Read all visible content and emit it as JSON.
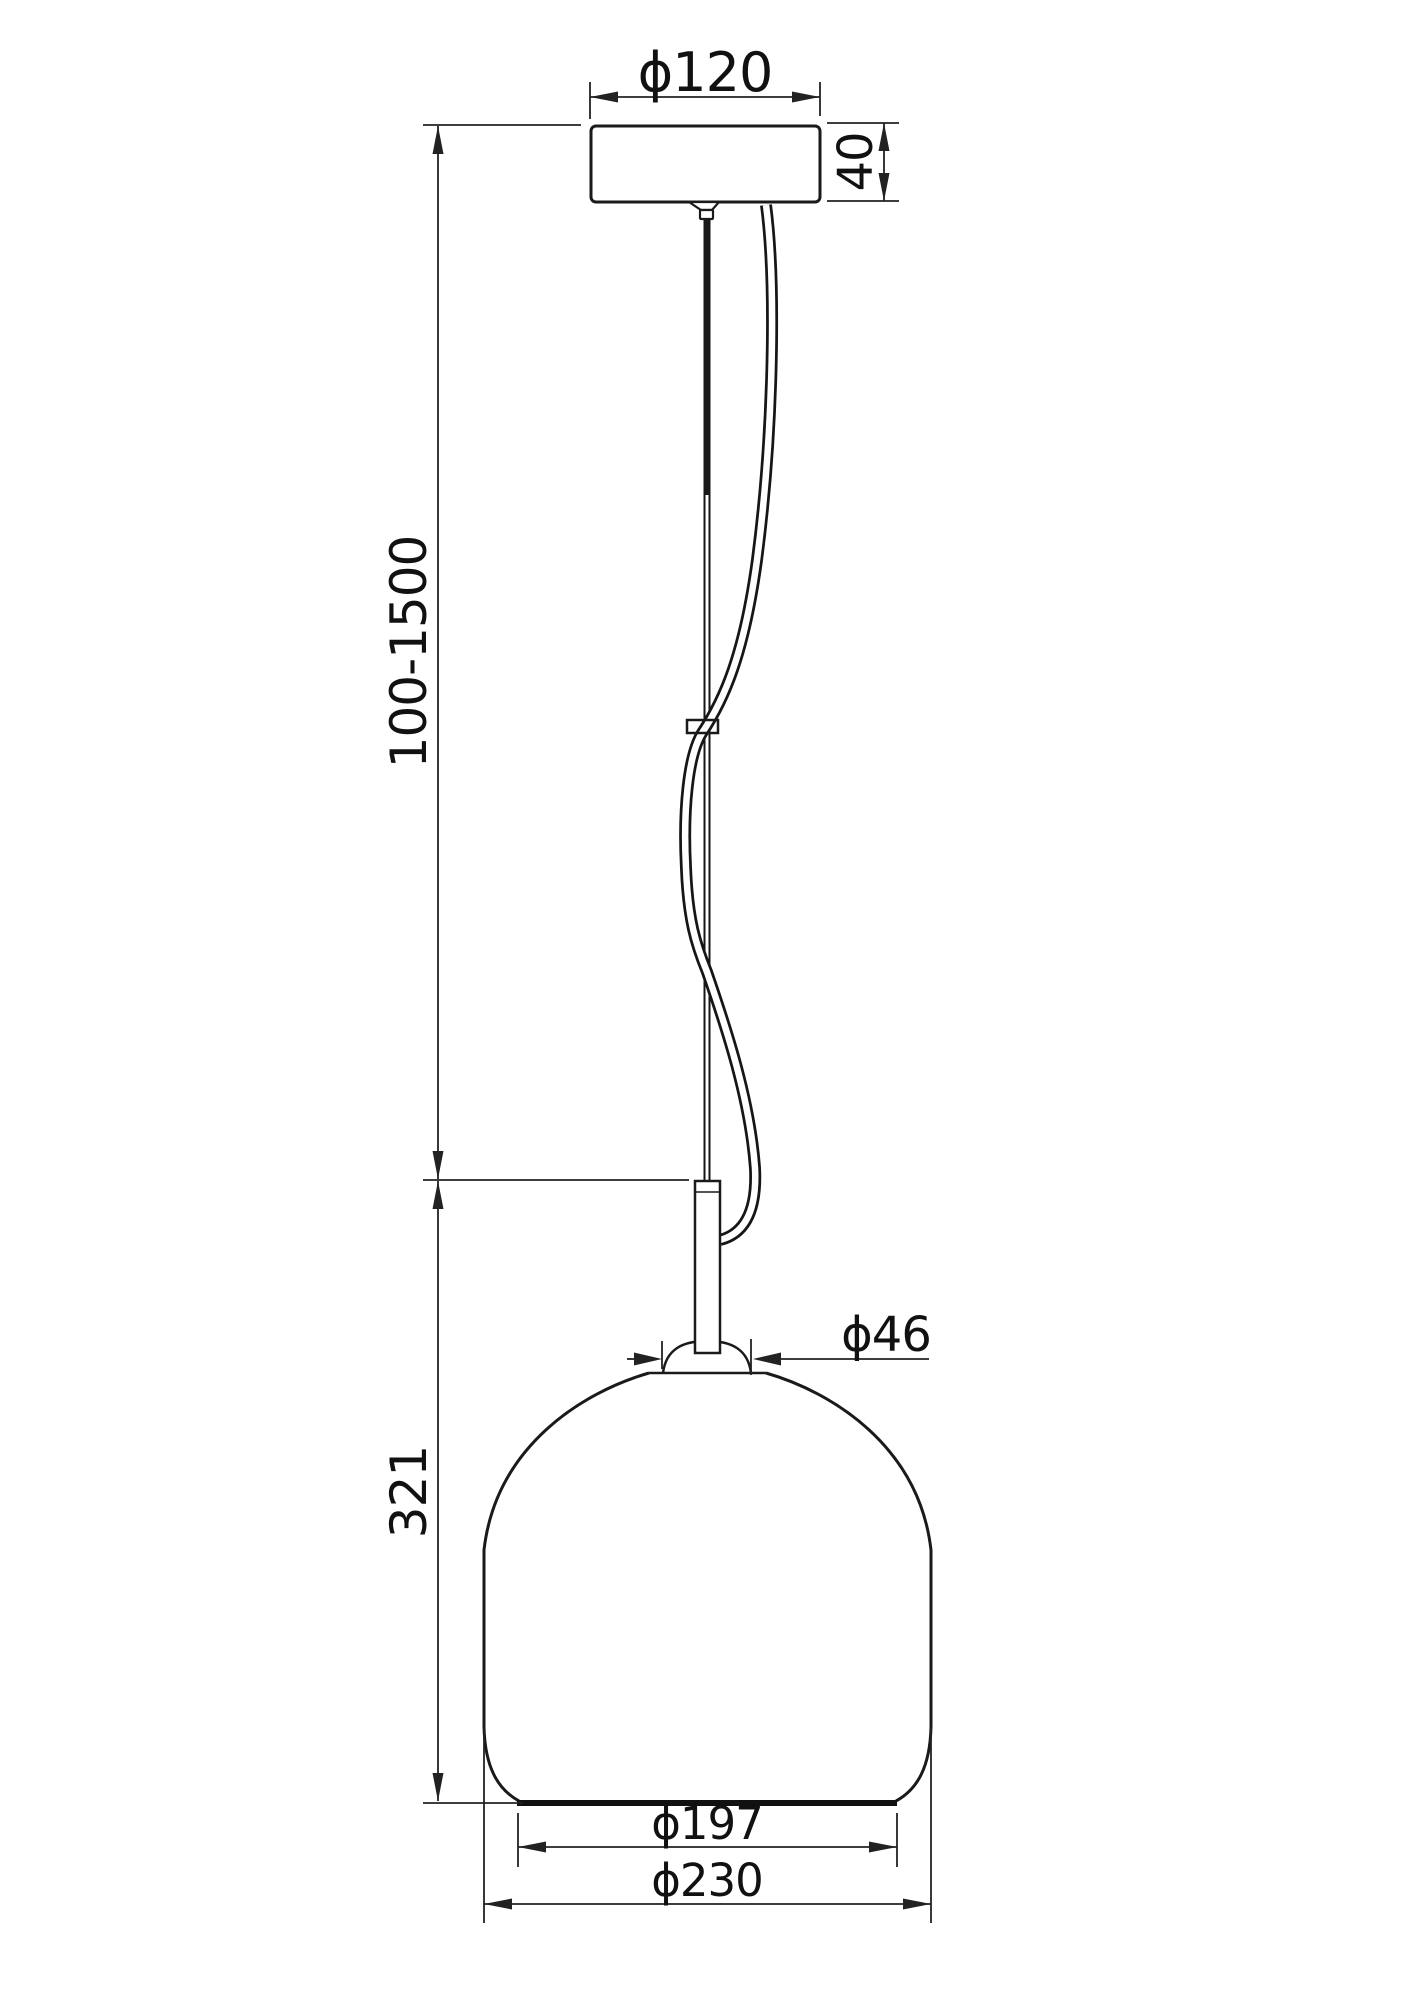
{
  "drawing": {
    "type": "pendant-lamp-dimension-drawing",
    "units_implied": "mm"
  },
  "dims": {
    "canopy_diameter": "ϕ120",
    "canopy_height": "40",
    "cable_length_range": "100-1500",
    "shade_height": "321",
    "neck_diameter": "ϕ46",
    "bottom_opening_diameter": "ϕ197",
    "max_diameter": "ϕ230"
  },
  "colors": {
    "line": "#1a1a1a",
    "dimension_line": "#222222",
    "background": "#ffffff"
  }
}
